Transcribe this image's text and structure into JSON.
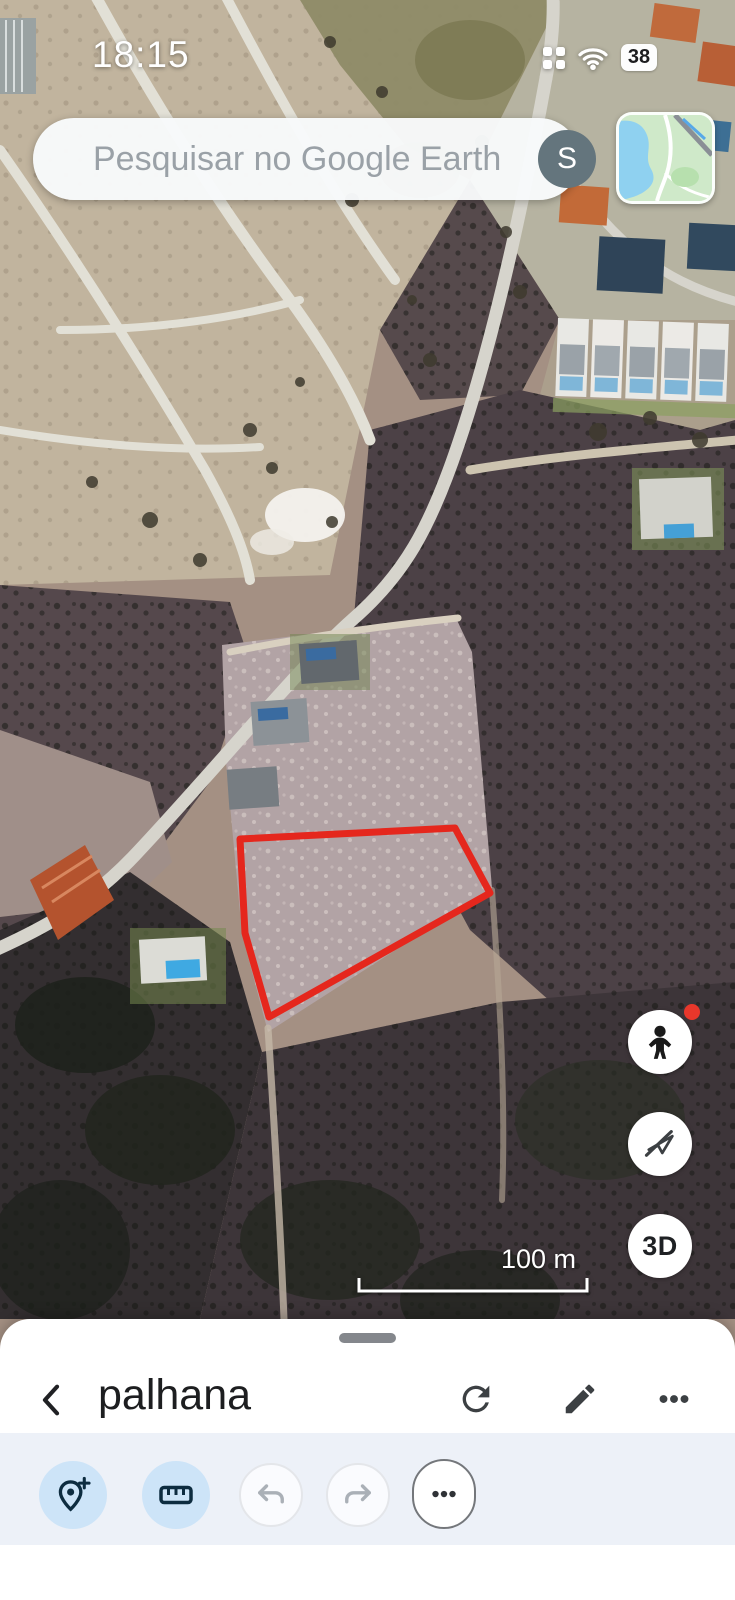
{
  "status_bar": {
    "time": "18:15",
    "battery_percent": "38"
  },
  "search": {
    "placeholder": "Pesquisar no Google Earth",
    "avatar_letter": "S"
  },
  "map": {
    "scale_label": "100 m",
    "threed_button_label": "3D",
    "parcel_outline_points": "240,839 455,828 490,893 269,1017 245,933",
    "parcel_outline_color": "#e5271d"
  },
  "bottom_sheet": {
    "title": "palhana",
    "toolbar": {
      "accent_active_bg": "#cde4f8",
      "accent_icon_color": "#0d2c40"
    }
  },
  "icons": {
    "status": [
      "grid-icon",
      "wifi-icon",
      "battery-icon"
    ],
    "search": [
      "search-icon",
      "avatar",
      "map-thumbnail"
    ],
    "map_side": [
      "pegman-icon",
      "plane-off-icon",
      "threed-button"
    ],
    "sheet_header": [
      "chevron-left-icon",
      "refresh-icon",
      "pencil-icon",
      "overflow-dots-icon"
    ],
    "toolbar": [
      "add-placemark-icon",
      "ruler-icon",
      "undo-icon",
      "redo-icon",
      "more-dots-icon"
    ]
  }
}
